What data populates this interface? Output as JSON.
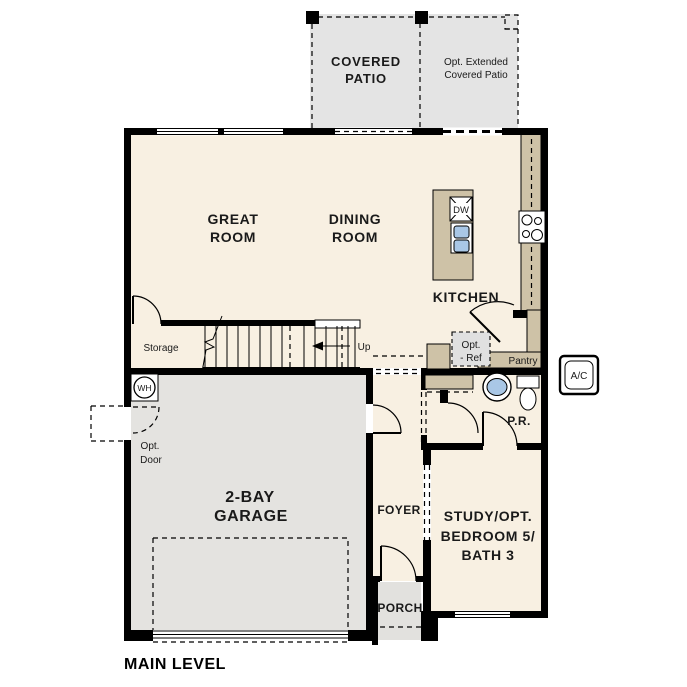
{
  "plan": {
    "title": "MAIN LEVEL",
    "labels": {
      "covered_patio_1": "COVERED",
      "covered_patio_2": "PATIO",
      "opt_patio_1": "Opt. Extended",
      "opt_patio_2": "Covered Patio",
      "great_room_1": "GREAT",
      "great_room_2": "ROOM",
      "dining_room_1": "DINING",
      "dining_room_2": "ROOM",
      "kitchen": "KITCHEN",
      "storage": "Storage",
      "up": "Up",
      "opt_ref_1": "Opt.",
      "opt_ref_2": "- Ref",
      "pantry": "Pantry",
      "wh": "WH",
      "opt_door_1": "Opt.",
      "opt_door_2": "Door",
      "garage_1": "2-BAY",
      "garage_2": "GARAGE",
      "foyer": "FOYER",
      "study_1": "STUDY/OPT.",
      "study_2": "BEDROOM 5/",
      "study_3": "BATH 3",
      "pr": "P.R.",
      "ac": "A/C",
      "porch": "PORCH",
      "dw": "DW"
    },
    "colors": {
      "floor": "#f8f0e2",
      "patio": "#e4e4e4",
      "garage": "#e4e3e0",
      "porch": "#e2e1de",
      "counter": "#cec2a7",
      "sink": "#a9c7e6",
      "wall": "#000000",
      "opt_box": "#e0e0e0"
    }
  }
}
